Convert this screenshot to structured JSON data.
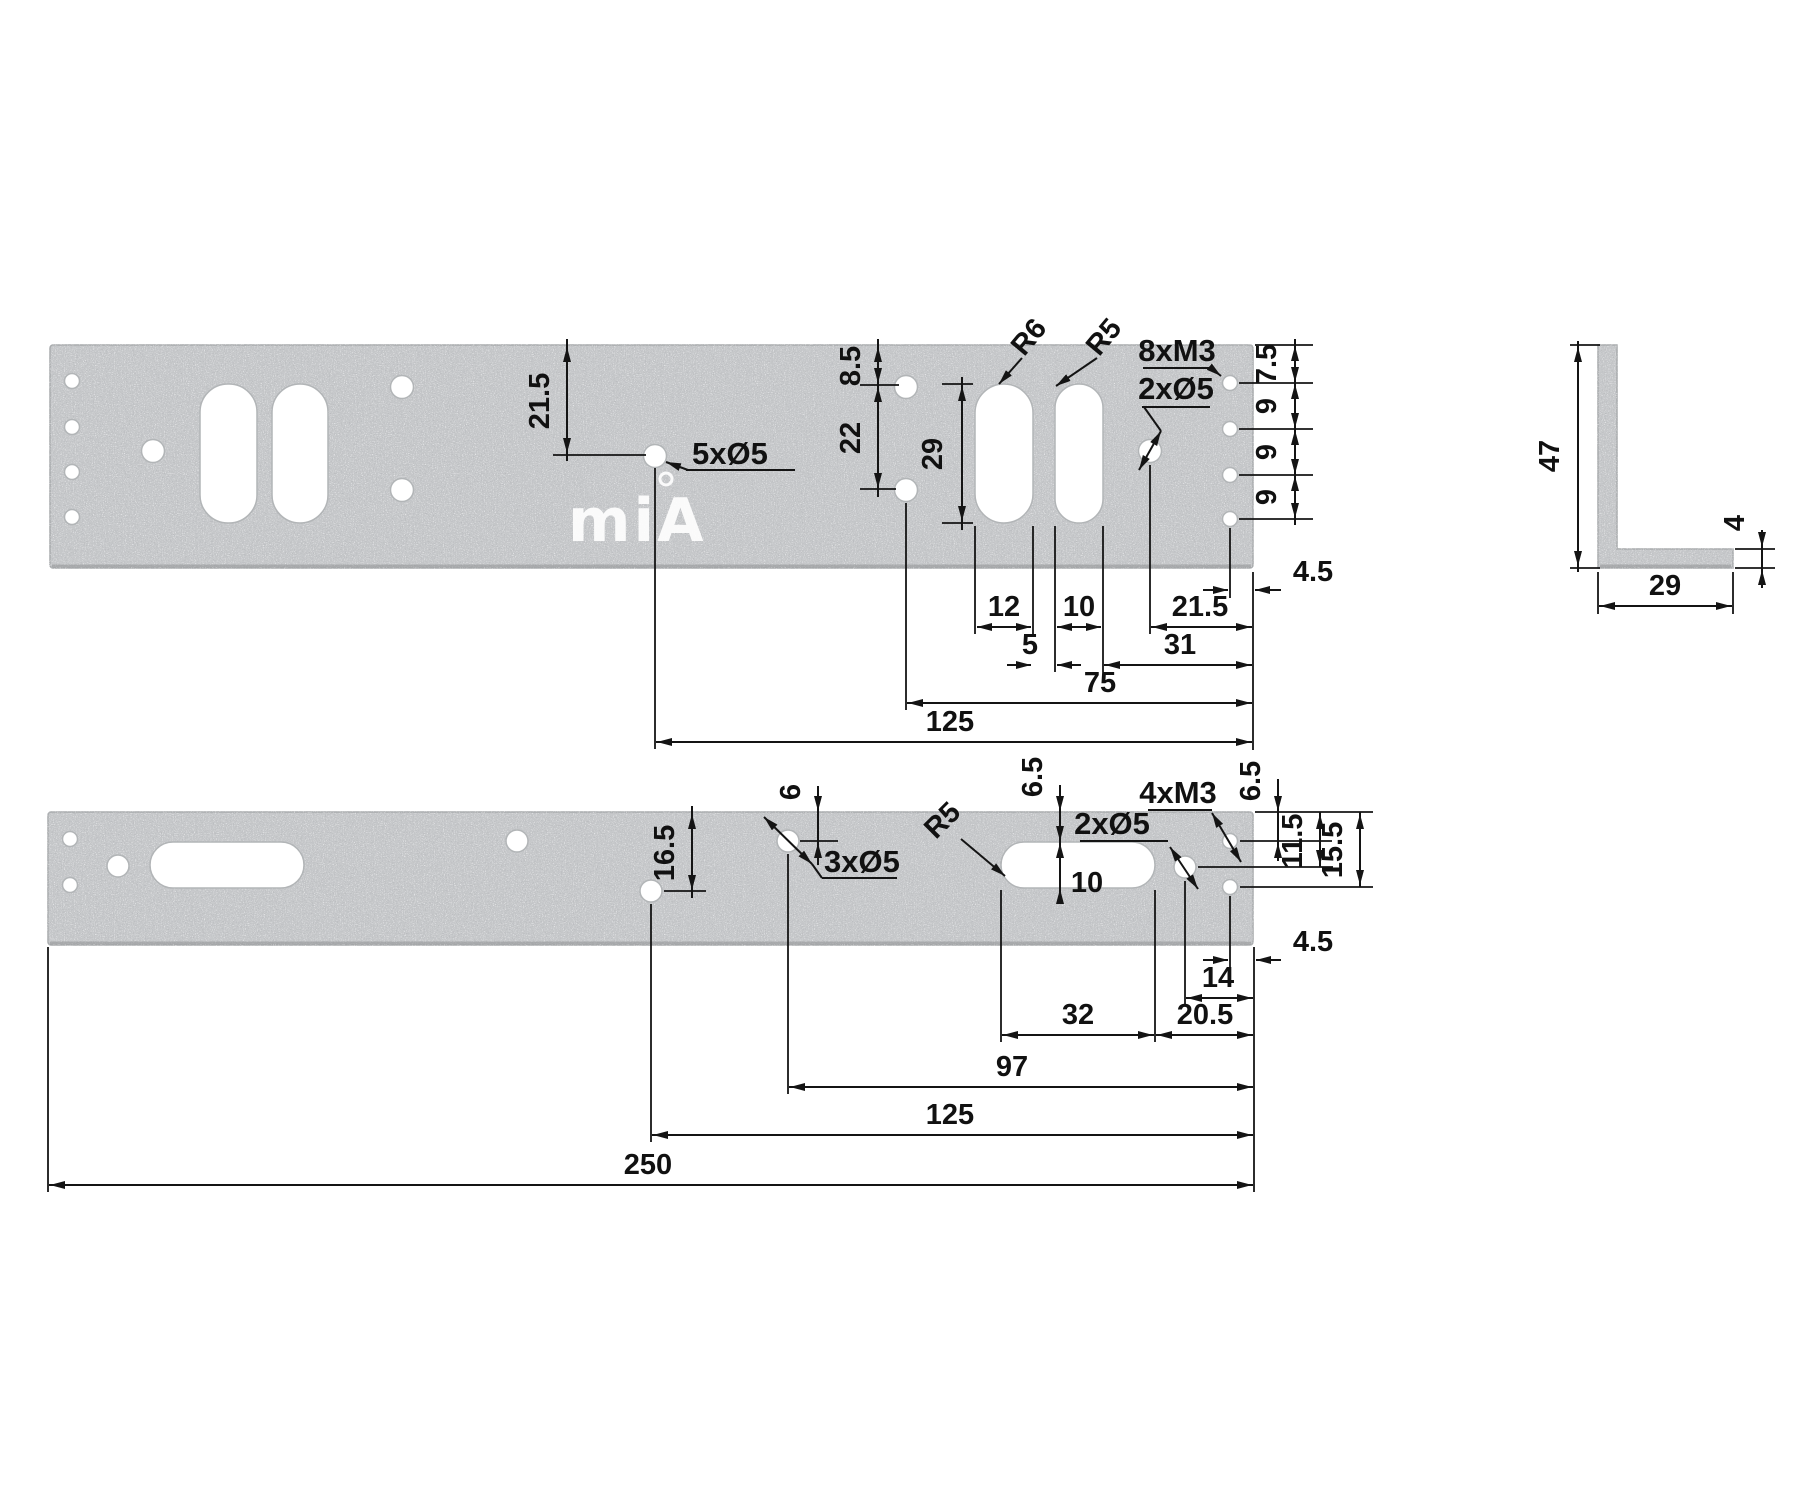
{
  "logo": {
    "text": "miA",
    "mark": "®"
  },
  "top_view": {
    "name": "mounting plate 250x47 face view",
    "dims": {
      "v21_5": "21.5",
      "note5x": "5xØ5",
      "v8_5": "8.5",
      "v22": "22",
      "v29": "29",
      "r6": "R6",
      "r5": "R5",
      "m8x3": "8xM3",
      "d2x5": "2xØ5",
      "c7_5": "7.5",
      "c9a": "9",
      "c9b": "9",
      "c9c": "9",
      "e4_5": "4.5",
      "w12": "12",
      "w10": "10",
      "g5": "5",
      "h21_5": "21.5",
      "h31": "31",
      "h75": "75",
      "h125": "125"
    }
  },
  "bottom_view": {
    "name": "mounting plate 250x29 face view",
    "dims": {
      "v16_5": "16.5",
      "v6": "6",
      "note3x": "3xØ5",
      "r5": "R5",
      "l6_5": "6.5",
      "s10": "10",
      "d2x5": "2xØ5",
      "m4x3": "4xM3",
      "r6_5": "6.5",
      "r11_5": "11.5",
      "r15_5": "15.5",
      "e4_5": "4.5",
      "h14": "14",
      "h32": "32",
      "h20_5": "20.5",
      "h97": "97",
      "h125": "125",
      "h250": "250"
    }
  },
  "side_view": {
    "name": "L profile cross-section",
    "dims": {
      "h47": "47",
      "t4": "4",
      "w29": "29"
    }
  },
  "colors": {
    "metal": "#c6c8ca",
    "metal_edge": "#8f9194",
    "line": "#141414",
    "background": "#ffffff"
  }
}
